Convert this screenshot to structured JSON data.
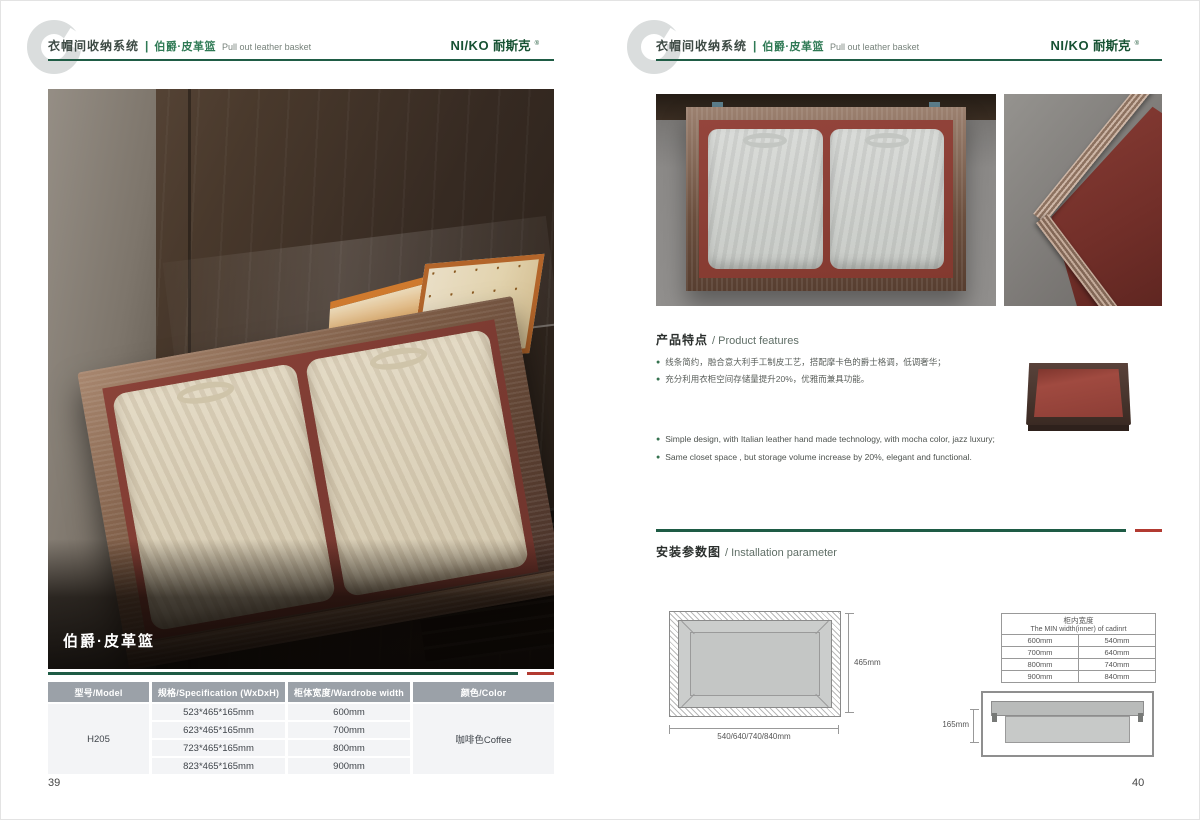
{
  "brand": {
    "logo_latin": "NI/KO",
    "logo_cn": "耐斯克",
    "logo_mark": "®"
  },
  "header": {
    "system_title": "衣帽间收纳系统",
    "divider": "|",
    "product_cn": "伯爵·皮革篮",
    "product_en": "Pull out leather basket"
  },
  "left_page": {
    "photo_caption": "伯爵·皮革篮",
    "page_number": "39",
    "spec_table": {
      "headers": [
        "型号/Model",
        "规格/Specification (WxDxH)",
        "柜体宽度/Wardrobe width",
        "颜色/Color"
      ],
      "model": "H205",
      "rows": [
        {
          "spec": "523*465*165mm",
          "wardrobe_width": "600mm"
        },
        {
          "spec": "623*465*165mm",
          "wardrobe_width": "700mm"
        },
        {
          "spec": "723*465*165mm",
          "wardrobe_width": "800mm"
        },
        {
          "spec": "823*465*165mm",
          "wardrobe_width": "900mm"
        }
      ],
      "color": "咖啡色Coffee"
    }
  },
  "right_page": {
    "page_number": "40",
    "features": {
      "title_cn": "产品特点",
      "title_en": "/ Product features",
      "bullets_cn": [
        "线条简约，融合意大利手工制皮工艺，搭配摩卡色的爵士格调，低调奢华；",
        "充分利用衣柜空间存储量提升20%，优雅而兼具功能。"
      ],
      "bullets_en": [
        "Simple design, with Italian leather hand made technology, with mocha color, jazz  luxury;",
        "Same closet space ,  but storage volume increase by 20%, elegant and functional."
      ]
    },
    "installation": {
      "title_cn": "安装参数图",
      "title_en": "/ Installation parameter",
      "front_view": {
        "height_label": "465mm",
        "width_label": "540/640/740/840mm"
      },
      "min_width_table": {
        "title_cn": "柜内宽度",
        "title_en": "The MIN width(inner) of cadinrt",
        "rows": [
          [
            "600mm",
            "540mm"
          ],
          [
            "700mm",
            "640mm"
          ],
          [
            "800mm",
            "740mm"
          ],
          [
            "900mm",
            "840mm"
          ]
        ]
      },
      "side_view": {
        "height_label": "165mm"
      }
    }
  },
  "colors": {
    "accent_green": "#1e5b45",
    "accent_red": "#b23a31",
    "logo_green": "#175233",
    "table_header_bg": "#9ba1a8"
  }
}
